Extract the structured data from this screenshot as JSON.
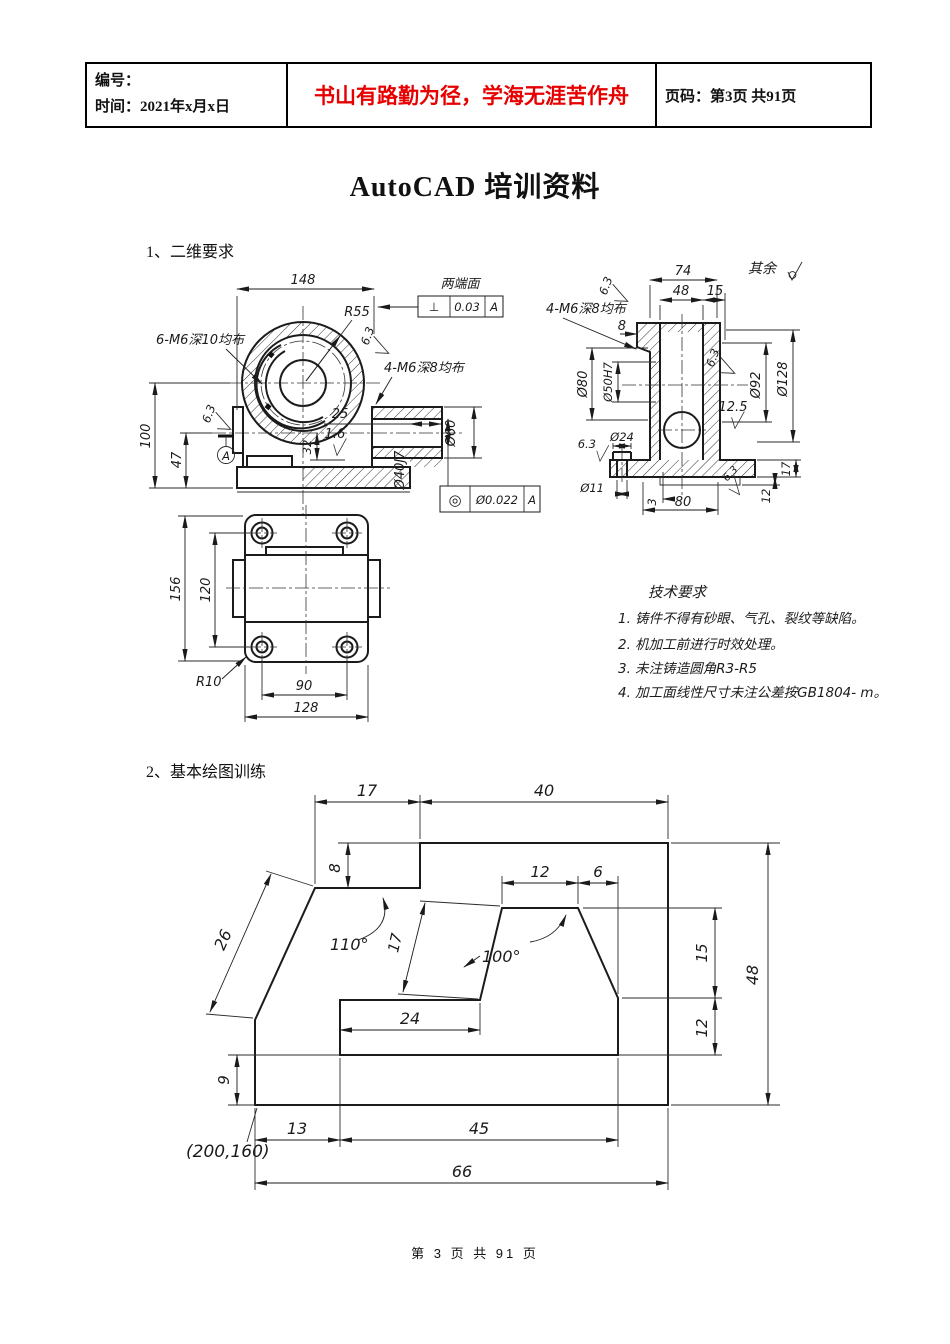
{
  "header": {
    "number_label": "编号：",
    "time_label": "时间：2021年x月x日",
    "slogan": "书山有路勤为径，学海无涯苦作舟",
    "slogan_color": "#e60000",
    "page_label": "页码：第3页 共91页"
  },
  "doc": {
    "title": "AutoCAD 培训资料",
    "section1": "1、二维要求",
    "section2": "2、基本绘图训练",
    "footer": "第 3 页 共 91 页"
  },
  "front": {
    "d148": "148",
    "r55": "R55",
    "n6m6": "6-M6深10均布",
    "n4m6": "4-M6深8均布",
    "fcf1_title": "两端面",
    "fcf1_sym": "⊥",
    "fcf1_tol": "0.03",
    "fcf1_datum": "A",
    "f63a": "6.3",
    "f63b": "6.3",
    "f16": "1.6",
    "d100": "100",
    "d47": "47",
    "d25": "25",
    "d32": "32",
    "d60": "Ø60",
    "d40": "Ø40J7",
    "fcf2_sym": "◎",
    "fcf2_tol": "Ø0.022",
    "fcf2_datum": "A",
    "datum": "A"
  },
  "side": {
    "d74": "74",
    "d48": "48",
    "d15": "15",
    "rest": "其余",
    "f63tl": "6.3",
    "n4m6": "4-M6深8均布",
    "d8": "8",
    "d80b": "Ø80",
    "d50": "Ø50H7",
    "f63r": "6.3",
    "d92": "Ø92",
    "d128": "Ø128",
    "f125": "12.5",
    "d24": "Ø24",
    "f63bl": "6.3",
    "d11": "Ø11",
    "d3": "3",
    "d80": "80",
    "d17": "17",
    "d12": "12",
    "f63br": "6.3"
  },
  "top": {
    "d156": "156",
    "d120": "120",
    "r10": "R10",
    "d90": "90",
    "d128": "128"
  },
  "tech": {
    "title": "技术要求",
    "items": [
      "1. 铸件不得有砂眼、气孔、裂纹等缺陷。",
      "2. 机加工前进行时效处理。",
      "3. 未注铸造圆角R3-R5",
      "4. 加工面线性尺寸未注公差按GB1804- m。"
    ]
  },
  "ex": {
    "d17": "17",
    "d40": "40",
    "d8": "8",
    "d12t": "12",
    "d6": "6",
    "d26": "26",
    "a110": "110°",
    "d17s": "17",
    "a100": "100°",
    "d15": "15",
    "d48": "48",
    "d24": "24",
    "d12r": "12",
    "d9": "9",
    "d13": "13",
    "d45": "45",
    "d66": "66",
    "origin": "(200,160)"
  }
}
